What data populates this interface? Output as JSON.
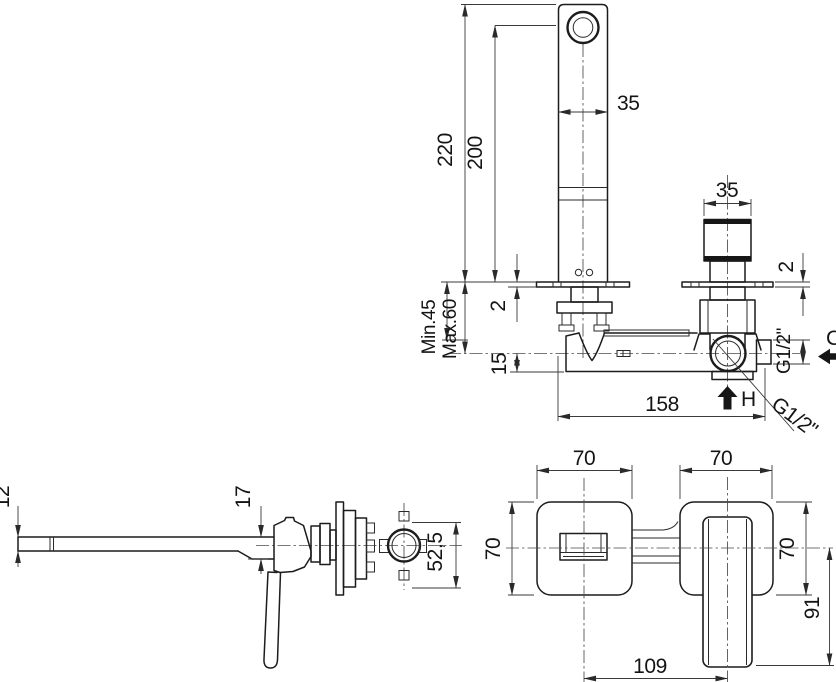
{
  "drawing": {
    "installation_view": {
      "spout_total_height": "220",
      "spout_outlet_height": "200",
      "spout_width": "35",
      "handle_width": "35",
      "spout_plate_thickness": "2",
      "handle_plate_thickness": "2",
      "min_depth": "Min.45",
      "max_depth": "Max.60",
      "axis_offset": "15",
      "body_length": "158",
      "hot_inlet": "H",
      "cold_inlet": "C",
      "side_thread": "G1/2\"",
      "bottom_thread": "G1/2\""
    },
    "side_view": {
      "spout_thickness": "12",
      "spout_root_height": "17",
      "body_depth": "52,5"
    },
    "front_view": {
      "spout_plate_width": "70",
      "handle_plate_width": "70",
      "spout_plate_height": "70",
      "handle_plate_height": "70",
      "handle_length_below_axis": "91",
      "axis_distance": "109"
    }
  }
}
